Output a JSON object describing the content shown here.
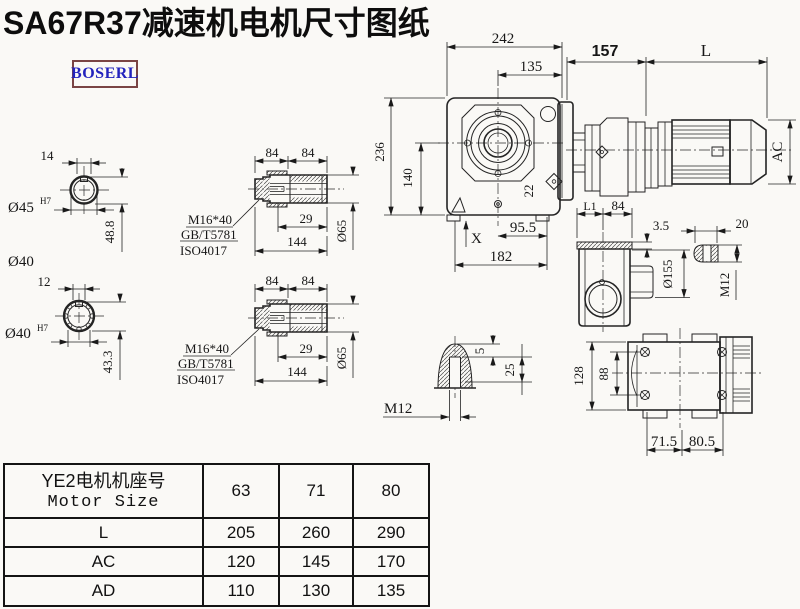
{
  "title": "SA67R37减速机电机尺寸图纸",
  "brand": {
    "logo": "BOSERL"
  },
  "colors": {
    "ink": "#1a1a1a",
    "logo_text": "#2323bd",
    "logo_border": "#7a4444",
    "background": "#faf9f6"
  },
  "shaft_section_top": {
    "key_width": "14",
    "bore_dia": "Ø45",
    "bore_fit": "H7",
    "depth": "48.8",
    "od_label": "Ø40"
  },
  "shaft_section_bottom": {
    "key_width": "12",
    "bore_dia": "Ø40",
    "bore_fit": "H7",
    "depth": "43.3"
  },
  "bushing_top": {
    "seg1": "84",
    "seg2": "84",
    "bolt_spec": "M16*40",
    "standard1": "GB/T5781",
    "standard2": "ISO4017",
    "thread_len": "29",
    "total_len": "144",
    "outer_dia": "Ø65"
  },
  "bushing_bottom": {
    "seg1": "84",
    "seg2": "84",
    "bolt_spec": "M16*40",
    "standard1": "GB/T5781",
    "standard2": "ISO4017",
    "thread_len": "29",
    "total_len": "144",
    "outer_dia": "Ø65"
  },
  "main_view": {
    "overall_width": "242",
    "center_to_flange": "135",
    "gearbox_length": "157",
    "motor_length": "L",
    "overall_height": "236",
    "center_height": "140",
    "bolt_size": "22",
    "motor_dia": "AC",
    "axis_label": "X",
    "foot_span": "95.5",
    "base_width": "182"
  },
  "side_view": {
    "dim_l1": "L1",
    "dim_84": "84",
    "plate_thickness": "3.5",
    "key_width": "20",
    "flange_dia": "Ø155",
    "thread": "M12"
  },
  "bottom_view": {
    "height": "128",
    "bolt_spacing": "88",
    "left_span": "71.5",
    "right_span": "80.5"
  },
  "shaft_end_detail": {
    "depth_5": "5",
    "depth_25": "25",
    "thread": "M12"
  },
  "table": {
    "header": {
      "cn": "YE2电机机座号",
      "en": "Motor Size"
    },
    "columns": [
      "63",
      "71",
      "80"
    ],
    "rows": [
      {
        "label": "L",
        "values": [
          "205",
          "260",
          "290"
        ]
      },
      {
        "label": "AC",
        "values": [
          "120",
          "145",
          "170"
        ]
      },
      {
        "label": "AD",
        "values": [
          "110",
          "130",
          "135"
        ]
      }
    ]
  }
}
